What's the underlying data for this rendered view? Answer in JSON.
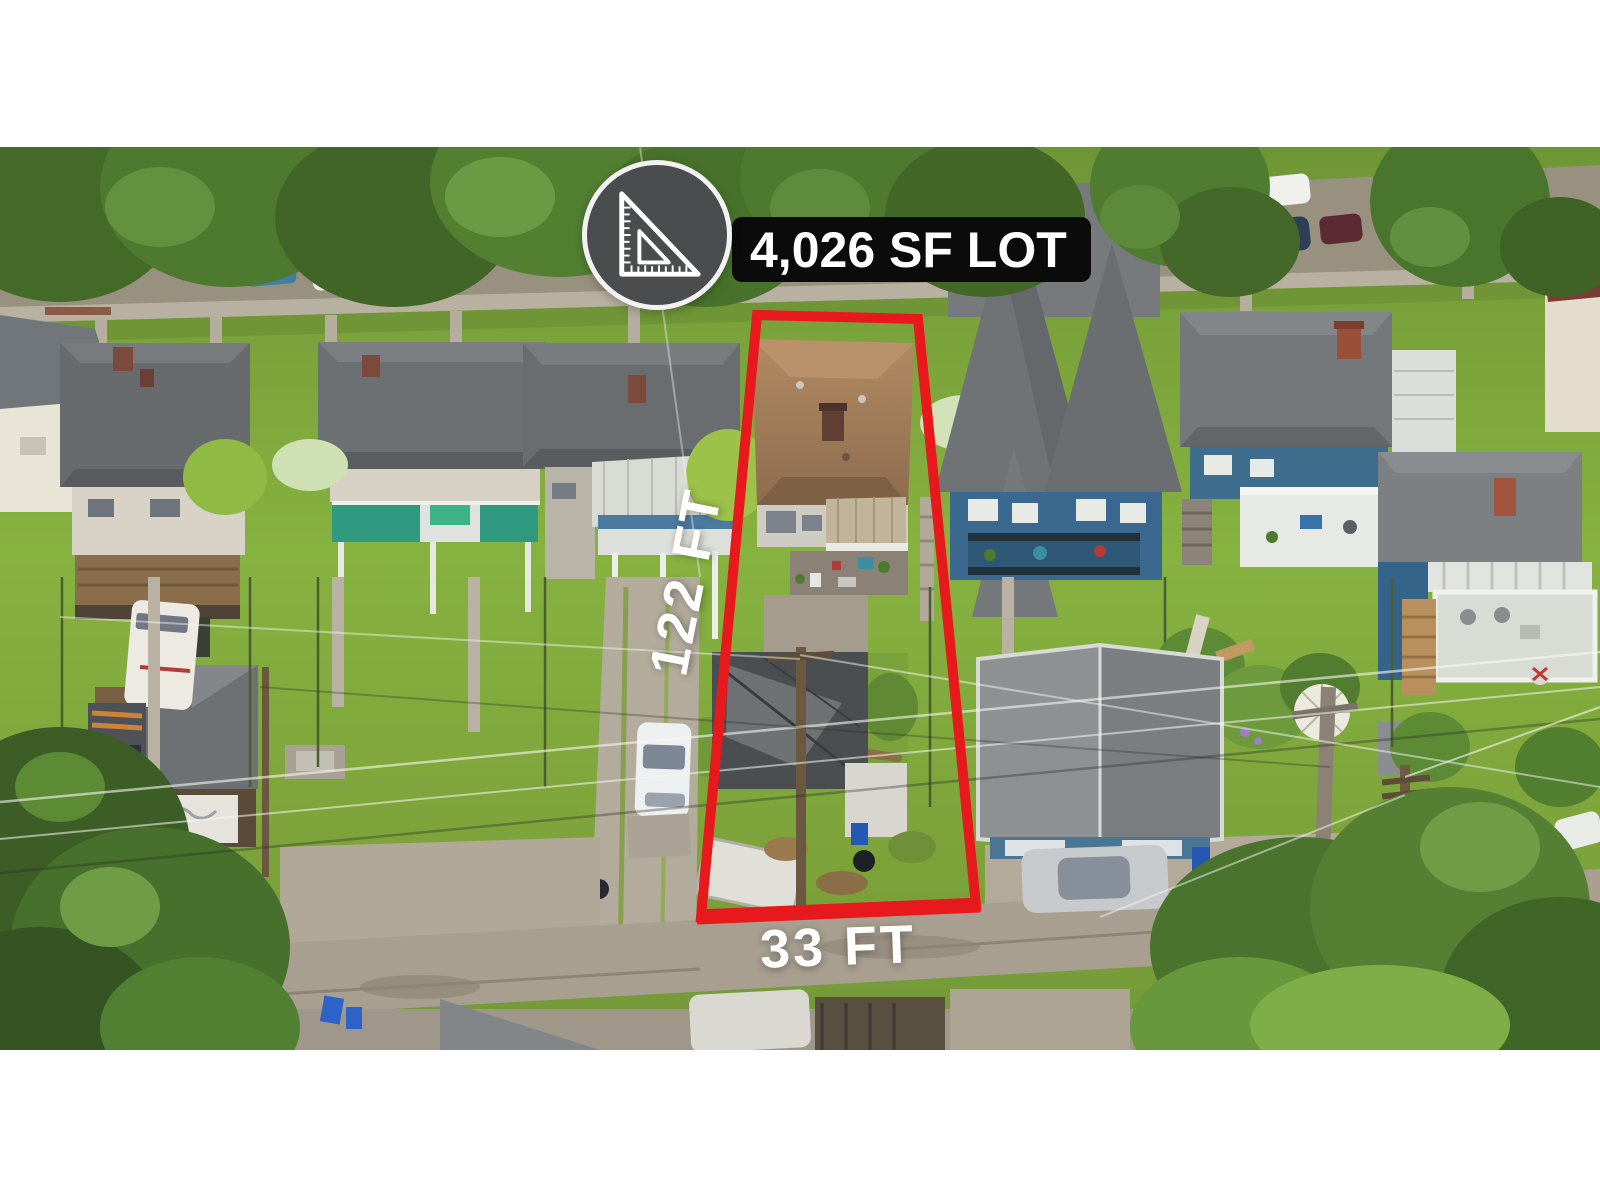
{
  "annotations": {
    "lot_size_label": "4,026 SF LOT",
    "depth_label": "122 FT",
    "frontage_label": "33 FT"
  },
  "icons": {
    "badge_icon": "set-square-ruler-icon"
  },
  "colors": {
    "outline_red": "#E8191C",
    "badge_circle_gray": "#4B4C4E",
    "badge_label_bg": "#0B0B0B",
    "label_text": "#FFFFFF"
  }
}
